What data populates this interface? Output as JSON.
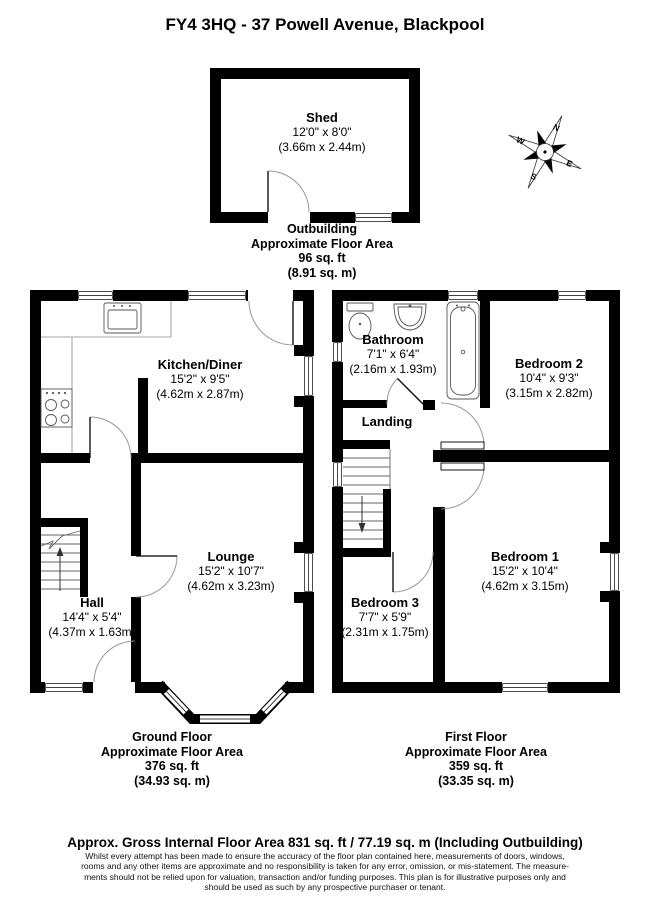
{
  "title": "FY4 3HQ - 37 Powell Avenue, Blackpool",
  "compass": {
    "north": "N",
    "east": "E",
    "south": "S",
    "west": "W"
  },
  "outbuilding": {
    "shed": {
      "name": "Shed",
      "imperial": "12'0\" x 8'0\"",
      "metric": "(3.66m x 2.44m)"
    },
    "footer": {
      "title": "Outbuilding",
      "subtitle": "Approximate Floor Area",
      "area_ft": "96 sq. ft",
      "area_m": "(8.91 sq. m)"
    }
  },
  "ground_floor": {
    "rooms": {
      "kitchen": {
        "name": "Kitchen/Diner",
        "imperial": "15'2\" x 9'5\"",
        "metric": "(4.62m x 2.87m)"
      },
      "lounge": {
        "name": "Lounge",
        "imperial": "15'2\" x 10'7\"",
        "metric": "(4.62m x 3.23m)"
      },
      "hall": {
        "name": "Hall",
        "imperial": "14'4\" x 5'4\"",
        "metric": "(4.37m x 1.63m)"
      }
    },
    "footer": {
      "title": "Ground Floor",
      "subtitle": "Approximate Floor Area",
      "area_ft": "376 sq. ft",
      "area_m": "(34.93 sq. m)"
    }
  },
  "first_floor": {
    "rooms": {
      "bathroom": {
        "name": "Bathroom",
        "imperial": "7'1\" x 6'4\"",
        "metric": "(2.16m x 1.93m)"
      },
      "landing": {
        "name": "Landing"
      },
      "bedroom2": {
        "name": "Bedroom 2",
        "imperial": "10'4\" x 9'3\"",
        "metric": "(3.15m x 2.82m)"
      },
      "bedroom1": {
        "name": "Bedroom 1",
        "imperial": "15'2\" x 10'4\"",
        "metric": "(4.62m x 3.15m)"
      },
      "bedroom3": {
        "name": "Bedroom 3",
        "imperial": "7'7\" x 5'9\"",
        "metric": "(2.31m x 1.75m)"
      }
    },
    "footer": {
      "title": "First Floor",
      "subtitle": "Approximate Floor Area",
      "area_ft": "359 sq. ft",
      "area_m": "(33.35 sq. m)"
    }
  },
  "summary": {
    "gross_area": "Approx. Gross Internal Floor Area 831 sq. ft / 77.19 sq. m (Including Outbuilding)",
    "disclaimer_lines": [
      "Whilst every attempt has been made to ensure the accuracy of the floor plan contained here, measurements of doors, windows,",
      "rooms and any other items are approximate and no responsibility is taken for any error, omission, or mis-statement. The measure-",
      "ments should not be relied upon for valuation, transaction and/or funding purposes. This plan is for illustrative purposes only and",
      "should be used as such by any prospective purchaser or tenant."
    ]
  },
  "colors": {
    "wall": "#000000",
    "background": "#ffffff",
    "fixture_line": "#555555",
    "door_arc": "#999999"
  }
}
